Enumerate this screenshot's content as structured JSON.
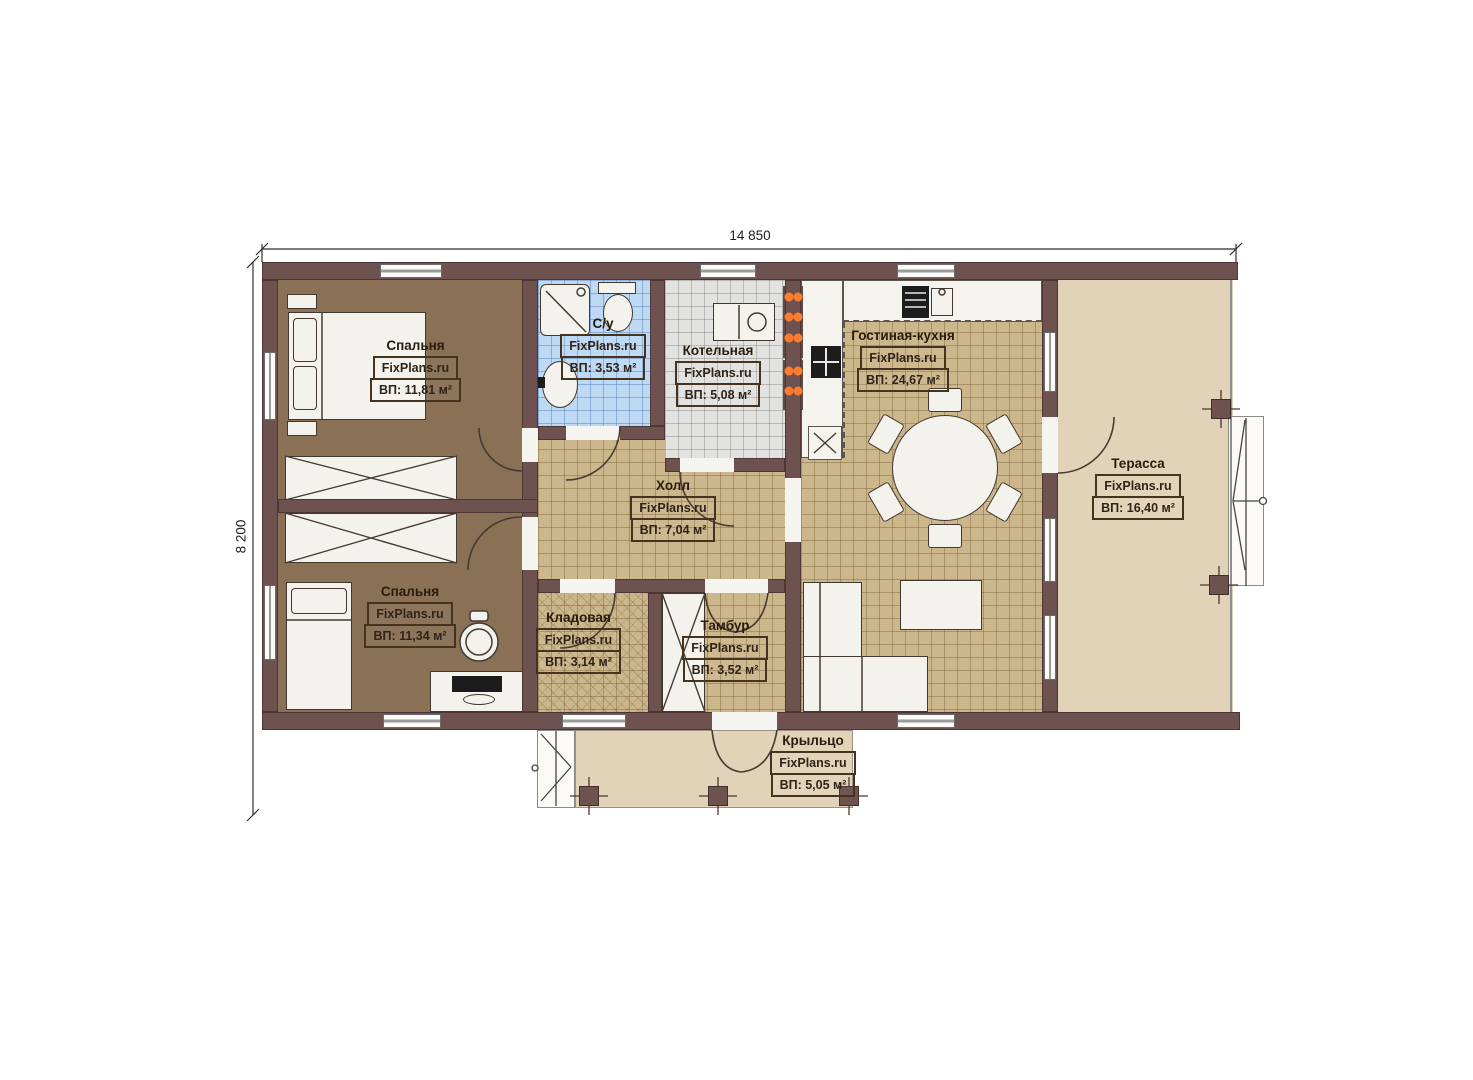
{
  "watermark": "FixPlans.ru",
  "dimensions": {
    "width": "14 850",
    "height": "8 200"
  },
  "rooms": {
    "bedroom1": {
      "name": "Спальня",
      "area": "ВП: 11,81 м²"
    },
    "bathroom": {
      "name": "С/у",
      "area": "ВП: 3,53 м²"
    },
    "boiler": {
      "name": "Котельная",
      "area": "ВП: 5,08 м²"
    },
    "living": {
      "name": "Гостиная-кухня",
      "area": "ВП: 24,67 м²"
    },
    "terrace": {
      "name": "Терасса",
      "area": "ВП: 16,40 м²"
    },
    "hall": {
      "name": "Холл",
      "area": "ВП: 7,04 м²"
    },
    "bedroom2": {
      "name": "Спальня",
      "area": "ВП: 11,34 м²"
    },
    "storage": {
      "name": "Кладовая",
      "area": "ВП: 3,14 м²"
    },
    "vestibule": {
      "name": "Тамбур",
      "area": "ВП: 3,52 м²"
    },
    "porch": {
      "name": "Крыльцо",
      "area": "ВП: 5,05 м²"
    }
  },
  "colors": {
    "wall": "#6d5250",
    "floor_bedroom": "#8a7156",
    "floor_tile": "#ccb68c",
    "floor_bath": "#bdd9f4",
    "floor_boiler": "#e2e2e1",
    "floor_terrace": "#e2d2b7",
    "accent_orange": "#ff7c2e"
  }
}
